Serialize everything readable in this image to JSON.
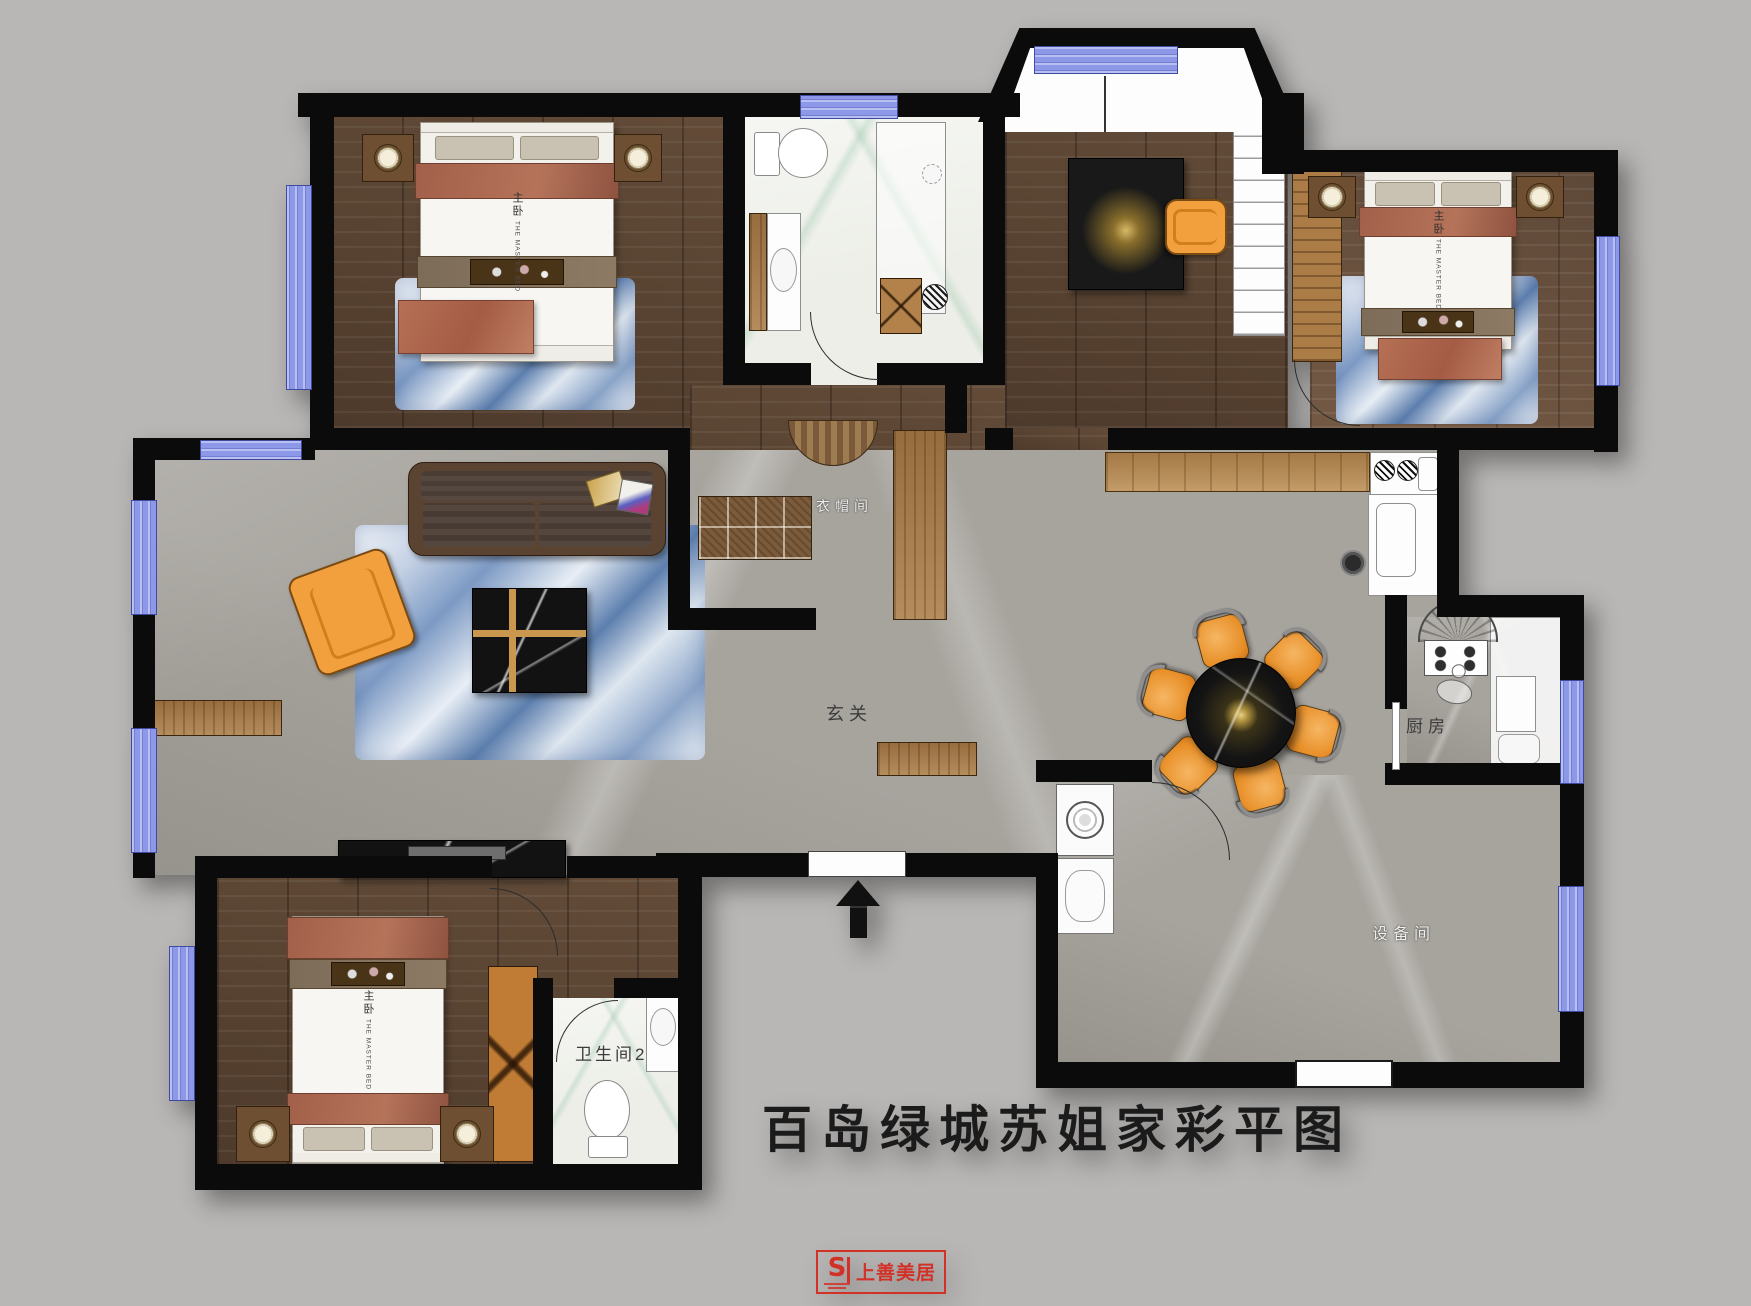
{
  "title": {
    "text": "百岛绿城苏姐家彩平图"
  },
  "logo": {
    "brand": "上善美居",
    "mark": "S"
  },
  "rooms": {
    "hall": "玄关",
    "cloakroom": "衣帽间",
    "kitchen": "厨房",
    "equipment": "设备间",
    "bathroom2": "卫生间2"
  },
  "beds": {
    "label_cn": "主卧",
    "label_en": "THE MASTER BED"
  },
  "colors": {
    "background": "#b9b7b5",
    "wall": "#0b0b0b",
    "window": "#8d98e9",
    "wood_floor": "#5e4837",
    "marble_floor": "#a7a49e",
    "bath_floor": "#eceee7",
    "rug_blue": "#7d9ac4",
    "accent_orange": "#f2a03e",
    "table_black": "#121212",
    "gold_inlay": "#c9974e",
    "logo_red": "#d23128"
  }
}
